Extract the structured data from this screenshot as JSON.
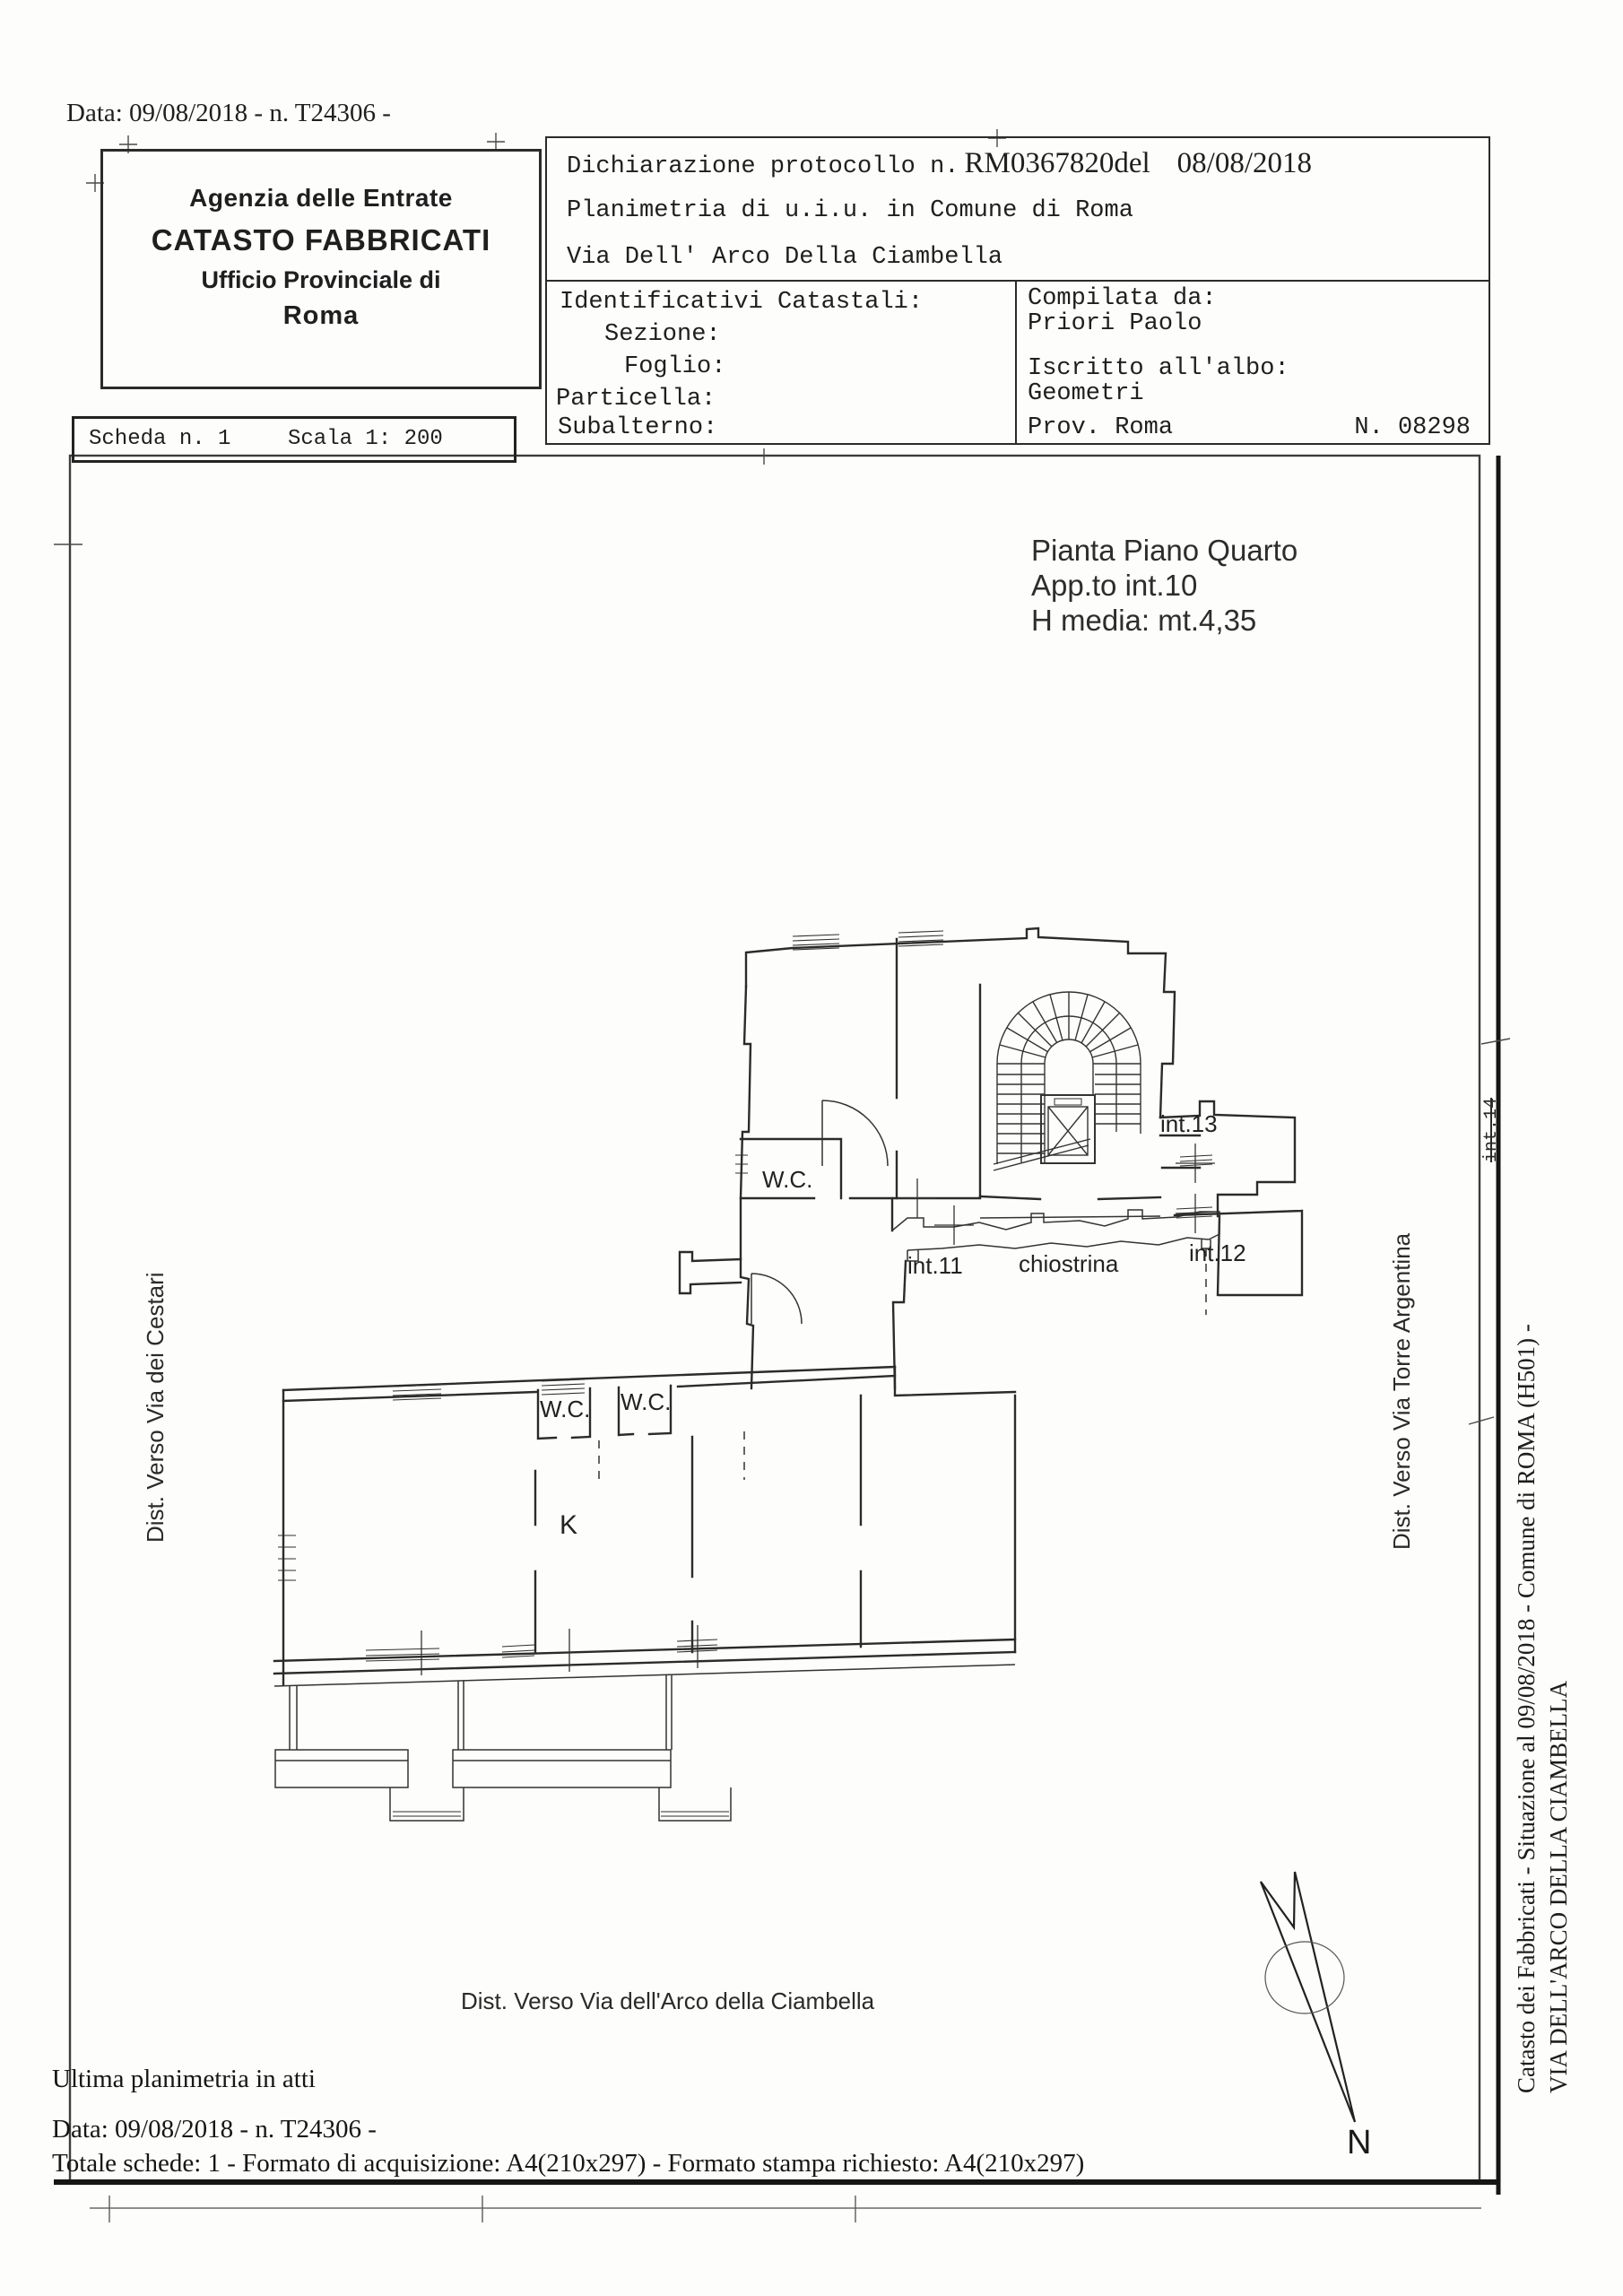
{
  "ink": "#1f1f1f",
  "top": {
    "date_line": "Data: 09/08/2018 - n. T24306 -"
  },
  "agency_box": {
    "line1": "Agenzia delle Entrate",
    "line2": "CATASTO FABBRICATI",
    "line3": "Ufficio Provinciale di",
    "line4": "Roma"
  },
  "declaration_box": {
    "protocol_prefix": "Dichiarazione protocollo n.",
    "protocol_number": "RM0367820del",
    "protocol_date": "08/08/2018",
    "line2": "Planimetria di u.i.u. in Comune di Roma",
    "line3": "Via Dell' Arco Della Ciambella"
  },
  "identifiers_box": {
    "title": "Identificativi Catastali:",
    "sezione": "Sezione:",
    "foglio": "Foglio:",
    "particella": "Particella:",
    "subalterno": "Subalterno:"
  },
  "compiler_box": {
    "label": "Compilata da:",
    "name": "Priori Paolo",
    "register_label": "Iscritto all'albo:",
    "register": "Geometri",
    "province": "Prov. Roma",
    "number": "N. 08298"
  },
  "sheet_box": {
    "sheet": "Scheda n. 1",
    "scale": "Scala 1: 200"
  },
  "plan": {
    "title1": "Pianta Piano Quarto",
    "title2": "App.to int.10",
    "title3": "H media: mt.4,35",
    "labels": {
      "wc_upper": "W.C.",
      "wc_left": "W.C.",
      "wc_right": "W.C.",
      "kitchen": "K",
      "int11": "int.11",
      "int12": "int.12",
      "int13": "int.13",
      "chiostrina": "chiostrina",
      "crossed_note": "int.14"
    },
    "directions": {
      "left": "Dist. Verso Via dei Cestari",
      "right": "Dist. Verso Via Torre Argentina",
      "bottom": "Dist. Verso Via dell'Arco della Ciambella"
    },
    "north": "N"
  },
  "margin_note": {
    "line1": "Catasto dei Fabbricati - Situazione al 09/08/2018 - Comune di ROMA (H501) -",
    "line2": "VIA DELL'ARCO DELLA CIAMBELLA"
  },
  "footer": {
    "line1": "Ultima planimetria in atti",
    "line2": "Data: 09/08/2018 - n. T24306 -",
    "line3": "Totale schede: 1 - Formato di acquisizione: A4(210x297)  - Formato stampa richiesto: A4(210x297)"
  }
}
